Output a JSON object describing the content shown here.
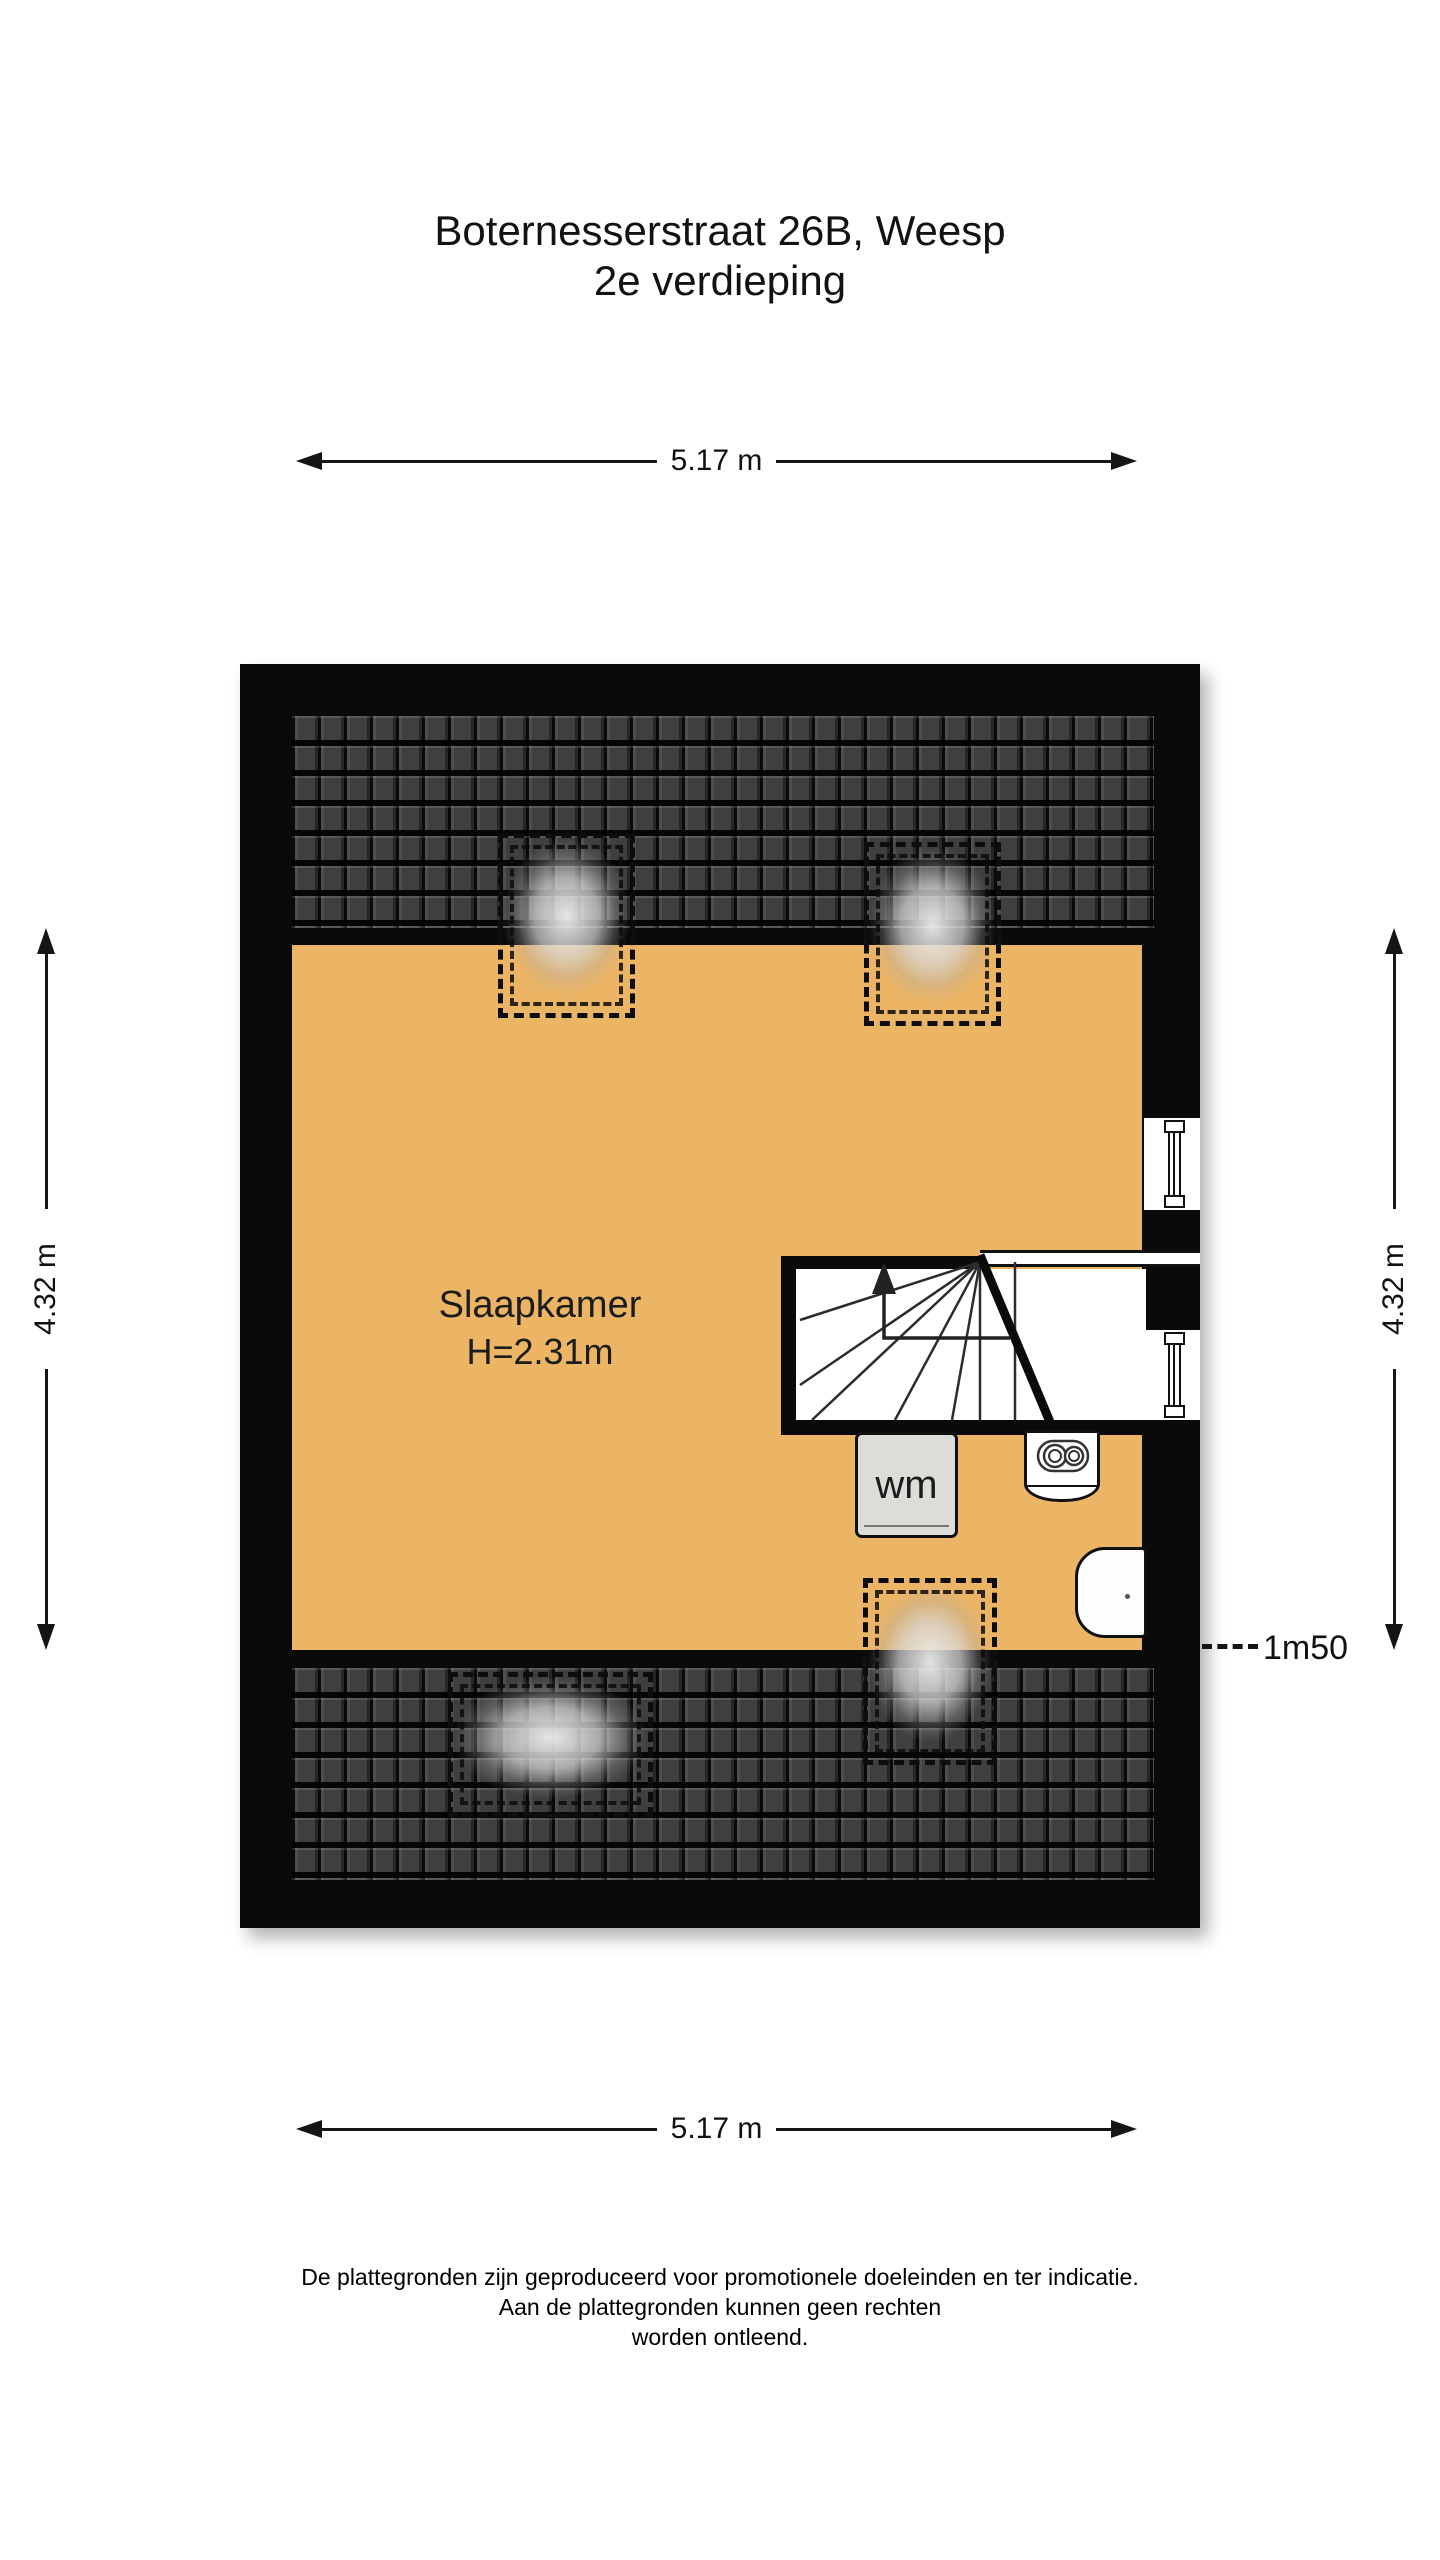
{
  "header": {
    "line1": "Boternesserstraat 26B, Weesp",
    "line2": "2e verdieping"
  },
  "dimensions": {
    "width_top": "5.17 m",
    "width_bottom": "5.17 m",
    "height_left": "4.32 m",
    "height_right": "4.32 m"
  },
  "room": {
    "name": "Slaapkamer",
    "ceiling_height": "H=2.31m"
  },
  "appliances": {
    "washing_machine": "wm"
  },
  "annotations": {
    "headroom": "1m50"
  },
  "colors": {
    "floor": "#ecb566",
    "wall": "#0a0a0a",
    "roof_tile": "#3f3f3f",
    "appliance_gray": "#dedcd8"
  },
  "footer": {
    "line1": "De plattegronden zijn geproduceerd voor promotionele doeleinden en ter indicatie.",
    "line2": "Aan de plattegronden kunnen geen rechten",
    "line3": "worden ontleend."
  }
}
